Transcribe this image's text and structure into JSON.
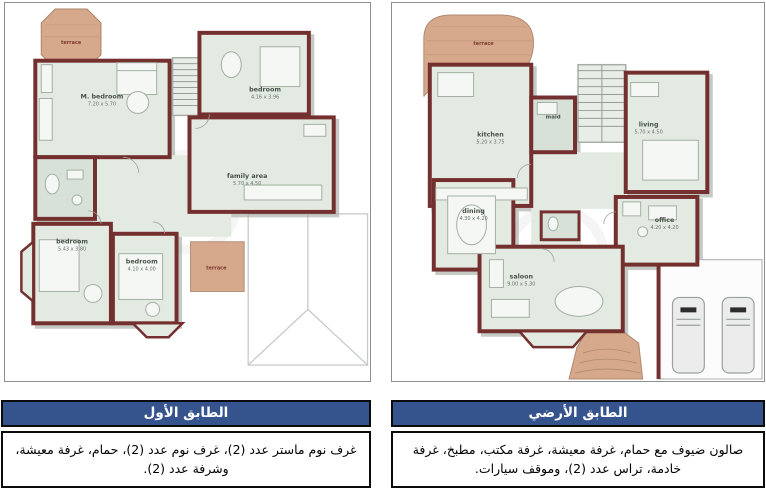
{
  "colors": {
    "title_bar_blue": "#35548E",
    "wall_maroon": "#74302E",
    "floor_green": "#E3EAE2",
    "terrace_tan": "#D6A88C"
  },
  "left_section": {
    "title": "الطابق الأول",
    "description": "غرف نوم ماستر عدد (2)، غرف نوم عدد (2)، حمام، غرفة معيشة، وشرفة عدد (2).",
    "plan": {
      "terrace_top": "terrace",
      "m_bedroom_name": "M. bedroom",
      "m_bedroom_dims": "7.20 x 5.70",
      "bedroom_top_name": "bedroom",
      "bedroom_top_dims": "4.16 x 3.96",
      "family_area_name": "family area",
      "family_area_dims": "5.70 x 4.50",
      "bedroom_left_name": "bedroom",
      "bedroom_left_dims": "5.43 x 3.80",
      "bedroom_mid_name": "bedroom",
      "bedroom_mid_dims": "4.10 x 4.00",
      "terrace_bottom": "terrace"
    }
  },
  "right_section": {
    "title": "الطابق الأرضي",
    "description": "صالون ضيوف مع حمام، غرفة معيشة، غرفة مكتب، مطبخ، غرفة خادمة، تراس عدد (2)، وموقف سيارات.",
    "plan": {
      "terrace": "terrace",
      "kitchen_name": "kitchen",
      "kitchen_dims": "5.20 x 3.75",
      "maid": "maid",
      "living_name": "living",
      "living_dims": "5.70 x 4.50",
      "dining_name": "dining",
      "dining_dims": "4.30 x 4.20",
      "office_name": "office",
      "office_dims": "4.20 x 4.20",
      "saloon_name": "saloon",
      "saloon_dims": "9.00 x 5.30"
    }
  }
}
